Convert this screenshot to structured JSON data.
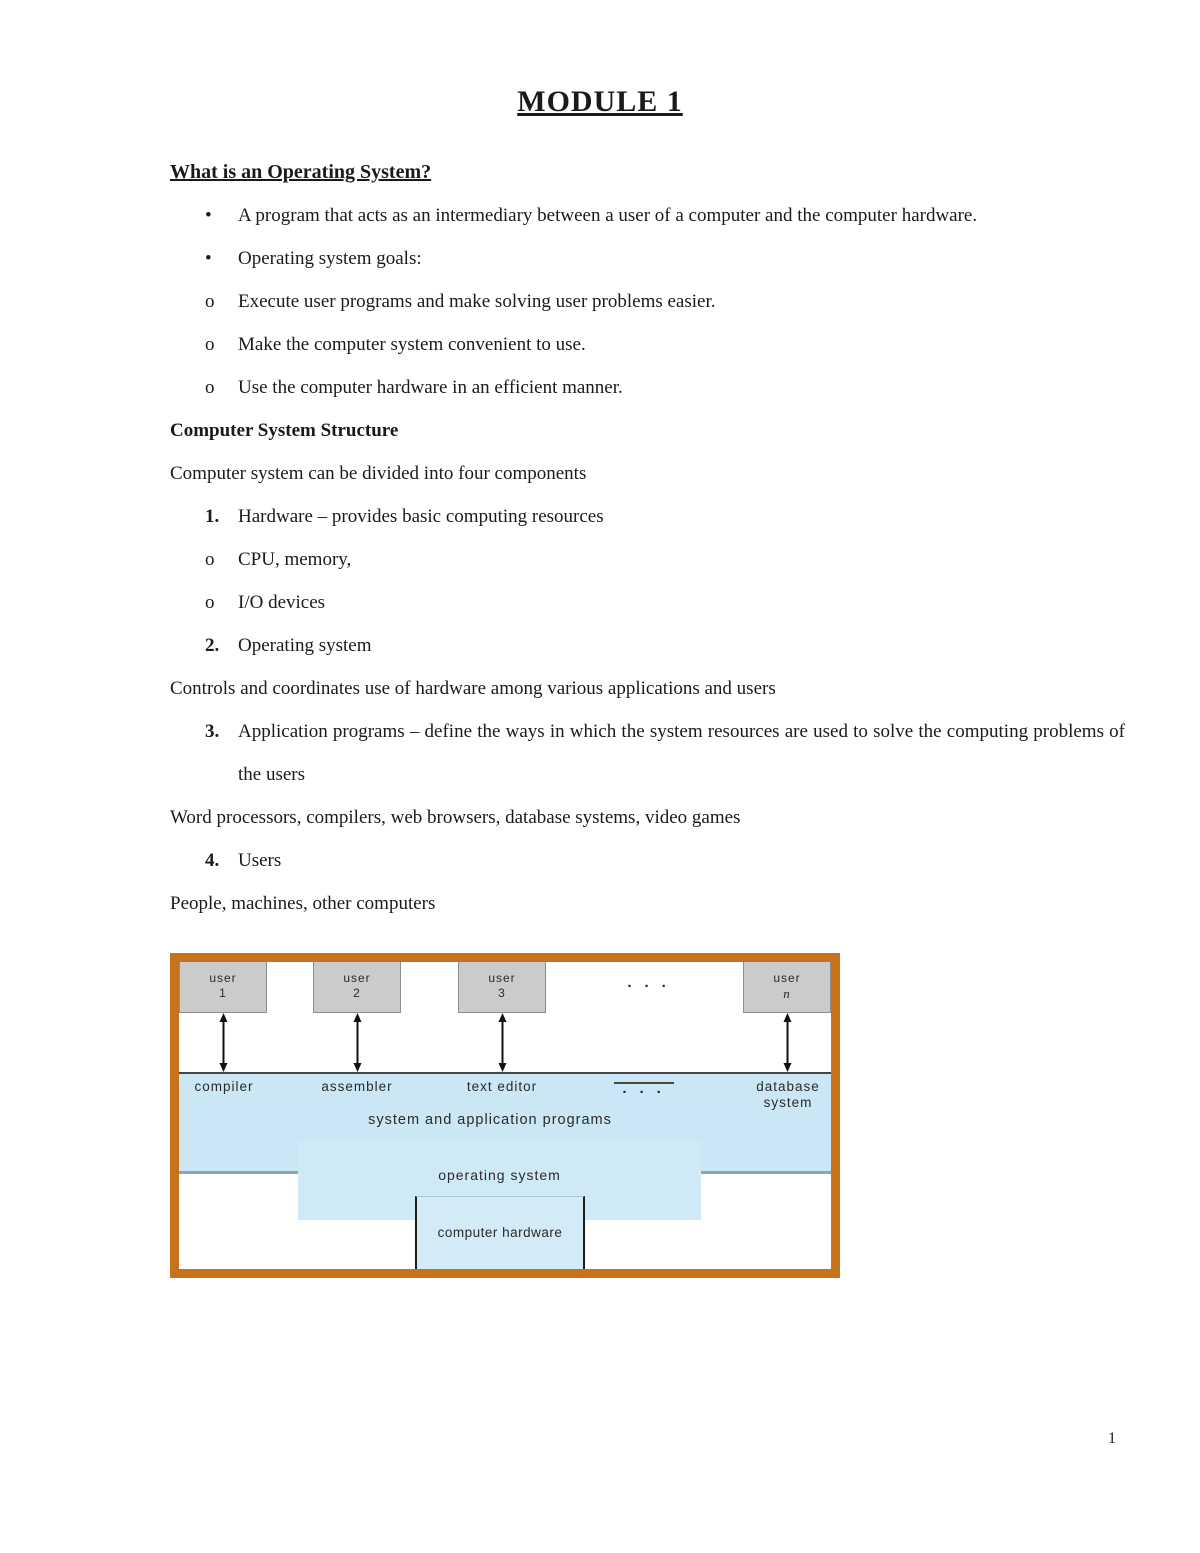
{
  "doc": {
    "title": "MODULE 1",
    "page_number": "1",
    "section1": {
      "heading": "What is an Operating System?",
      "bullets": [
        {
          "marker": "•",
          "text": "A program that acts as an intermediary between a user of a computer and the computer hardware."
        },
        {
          "marker": "•",
          "text": "Operating system goals:"
        },
        {
          "marker": "o",
          "text": "Execute user programs and make solving user problems easier."
        },
        {
          "marker": "o",
          "text": "Make the computer system convenient to use."
        },
        {
          "marker": "o",
          "text": "Use the computer hardware in an efficient manner."
        }
      ]
    },
    "section2": {
      "heading": "Computer System Structure",
      "intro": "Computer system can be divided into four components",
      "items": [
        {
          "marker": "1.",
          "text": "Hardware – provides basic computing resources"
        },
        {
          "marker": "o",
          "text": "CPU, memory,"
        },
        {
          "marker": "o",
          "text": "I/O devices"
        },
        {
          "marker": "2.",
          "text": "Operating system"
        },
        {
          "marker": "3.",
          "text": "Application programs – define the ways in which the system resources are used to solve the computing problems of the users"
        },
        {
          "marker": "4.",
          "text": "Users"
        }
      ],
      "para_controls": "Controls and coordinates use of hardware among various applications and users",
      "para_examples": "Word processors, compilers, web browsers, database systems, video games",
      "para_users": "People, machines, other computers"
    }
  },
  "diagram": {
    "users": [
      {
        "label": "user",
        "id": "1"
      },
      {
        "label": "user",
        "id": "2"
      },
      {
        "label": "user",
        "id": "3"
      },
      {
        "label": "user",
        "id": "n"
      }
    ],
    "ellipsis": "· · ·",
    "programs": [
      "compiler",
      "assembler",
      "text editor",
      "database system"
    ],
    "band_title": "system and application programs",
    "os_label": "operating system",
    "hardware_label": "computer hardware",
    "colors": {
      "border": "#c9721c",
      "band": "#cbe7f5",
      "os_box": "#cfe9f6",
      "hardware_box": "#d3eaf7",
      "user_box": "#cbcbcb"
    }
  }
}
